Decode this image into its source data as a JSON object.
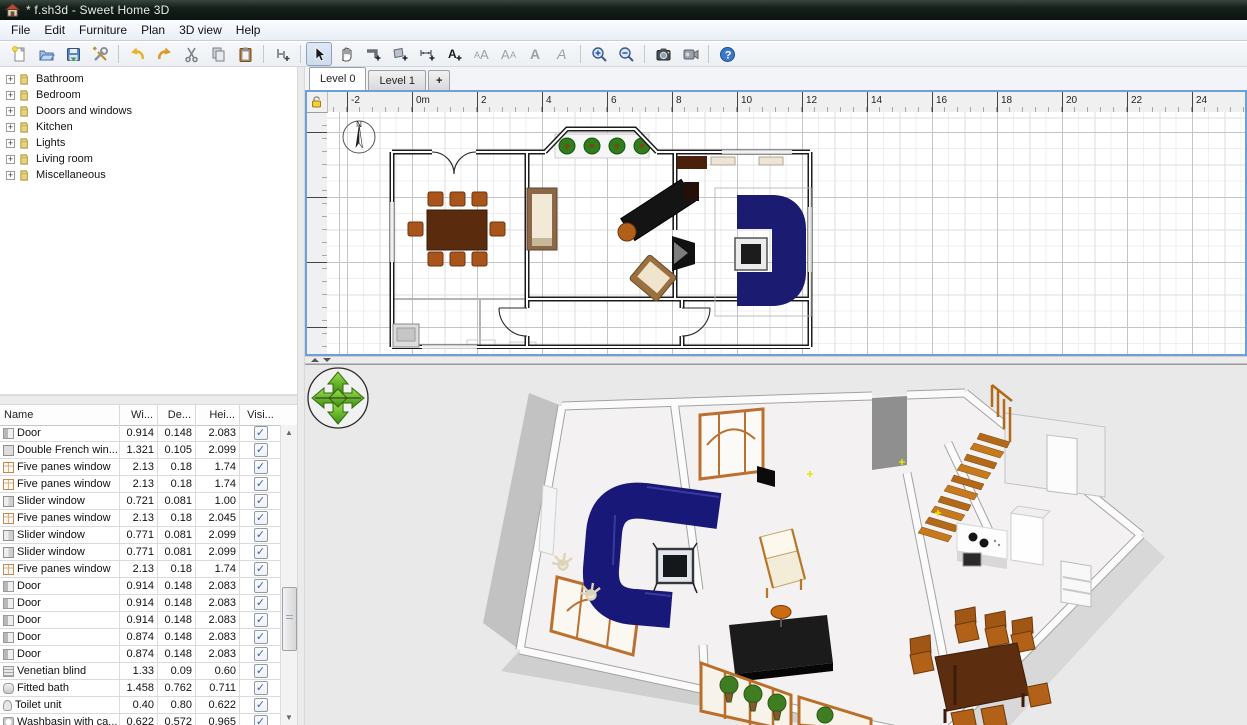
{
  "window": {
    "title": "* f.sh3d - Sweet Home 3D"
  },
  "menu": {
    "items": [
      "File",
      "Edit",
      "Furniture",
      "Plan",
      "3D view",
      "Help"
    ]
  },
  "toolbar": {
    "buttons": [
      {
        "icon": "new-document"
      },
      {
        "icon": "open"
      },
      {
        "icon": "save"
      },
      {
        "icon": "preferences"
      },
      {
        "icon": "undo"
      },
      {
        "icon": "redo"
      },
      {
        "icon": "cut"
      },
      {
        "icon": "copy"
      },
      {
        "icon": "paste"
      },
      {
        "icon": "add-furniture"
      },
      {
        "icon": "select",
        "active": true
      },
      {
        "icon": "pan"
      },
      {
        "icon": "create-walls"
      },
      {
        "icon": "create-rooms"
      },
      {
        "icon": "create-dimensions"
      },
      {
        "icon": "add-text"
      },
      {
        "icon": "decrease-text-size",
        "disabled": true
      },
      {
        "icon": "increase-text-size",
        "disabled": true
      },
      {
        "icon": "bold",
        "disabled": true
      },
      {
        "icon": "italic",
        "disabled": true
      },
      {
        "icon": "zoom-in"
      },
      {
        "icon": "zoom-out"
      },
      {
        "icon": "create-photo"
      },
      {
        "icon": "create-video"
      },
      {
        "icon": "help"
      }
    ]
  },
  "catalog": {
    "categories": [
      {
        "label": "Bathroom"
      },
      {
        "label": "Bedroom"
      },
      {
        "label": "Doors and windows"
      },
      {
        "label": "Kitchen"
      },
      {
        "label": "Lights"
      },
      {
        "label": "Living room"
      },
      {
        "label": "Miscellaneous"
      }
    ]
  },
  "furniture_table": {
    "columns": [
      "Name",
      "Wi...",
      "De...",
      "Hei...",
      "Visi..."
    ],
    "rows": [
      {
        "icon": "door",
        "name": "Door",
        "width": "0.914",
        "depth": "0.148",
        "height": "2.083",
        "visible": true
      },
      {
        "icon": "double-window",
        "name": "Double French win...",
        "width": "1.321",
        "depth": "0.105",
        "height": "2.099",
        "visible": true
      },
      {
        "icon": "five-panes-window",
        "name": "Five panes window",
        "width": "2.13",
        "depth": "0.18",
        "height": "1.74",
        "visible": true
      },
      {
        "icon": "five-panes-window",
        "name": "Five panes window",
        "width": "2.13",
        "depth": "0.18",
        "height": "1.74",
        "visible": true
      },
      {
        "icon": "slider-window",
        "name": "Slider window",
        "width": "0.721",
        "depth": "0.081",
        "height": "1.00",
        "visible": true
      },
      {
        "icon": "five-panes-window",
        "name": "Five panes window",
        "width": "2.13",
        "depth": "0.18",
        "height": "2.045",
        "visible": true
      },
      {
        "icon": "slider-window",
        "name": "Slider window",
        "width": "0.771",
        "depth": "0.081",
        "height": "2.099",
        "visible": true
      },
      {
        "icon": "slider-window",
        "name": "Slider window",
        "width": "0.771",
        "depth": "0.081",
        "height": "2.099",
        "visible": true
      },
      {
        "icon": "five-panes-window",
        "name": "Five panes window",
        "width": "2.13",
        "depth": "0.18",
        "height": "1.74",
        "visible": true
      },
      {
        "icon": "door",
        "name": "Door",
        "width": "0.914",
        "depth": "0.148",
        "height": "2.083",
        "visible": true
      },
      {
        "icon": "door",
        "name": "Door",
        "width": "0.914",
        "depth": "0.148",
        "height": "2.083",
        "visible": true
      },
      {
        "icon": "door",
        "name": "Door",
        "width": "0.914",
        "depth": "0.148",
        "height": "2.083",
        "visible": true
      },
      {
        "icon": "door",
        "name": "Door",
        "width": "0.874",
        "depth": "0.148",
        "height": "2.083",
        "visible": true
      },
      {
        "icon": "door",
        "name": "Door",
        "width": "0.874",
        "depth": "0.148",
        "height": "2.083",
        "visible": true
      },
      {
        "icon": "blind",
        "name": "Venetian blind",
        "width": "1.33",
        "depth": "0.09",
        "height": "0.60",
        "visible": true
      },
      {
        "icon": "bath",
        "name": "Fitted bath",
        "width": "1.458",
        "depth": "0.762",
        "height": "0.711",
        "visible": true
      },
      {
        "icon": "toilet",
        "name": "Toilet unit",
        "width": "0.40",
        "depth": "0.80",
        "height": "0.622",
        "visible": true
      },
      {
        "icon": "washbasin",
        "name": "Washbasin with ca...",
        "width": "0.622",
        "depth": "0.572",
        "height": "0.965",
        "visible": true
      },
      {
        "icon": "shower",
        "name": "Shower",
        "width": "0.787",
        "depth": "0.787",
        "height": "2.108",
        "visible": true
      }
    ]
  },
  "plan": {
    "tabs": [
      {
        "label": "Level 0",
        "selected": true
      },
      {
        "label": "Level 1",
        "selected": false
      },
      {
        "label": "+",
        "selected": false
      }
    ],
    "h_ruler": {
      "labels": [
        "-2",
        "0m",
        "2",
        "4",
        "6",
        "8",
        "10",
        "12",
        "14",
        "16",
        "18",
        "20",
        "22",
        "24"
      ]
    },
    "v_ruler": {
      "labels": [
        "0m",
        "2",
        "4",
        "6"
      ]
    },
    "compass_label": "N"
  },
  "colors": {
    "plan_focus_border": "#6f9fd8",
    "sofa_navy": "#1b1b72",
    "wood_dark": "#5a2b0c",
    "wood_chair": "#a8541a",
    "stairs_orange": "#c7791d",
    "view3d_background": "#e9e9e9",
    "nav_arrow_green": "#5cb82a"
  }
}
